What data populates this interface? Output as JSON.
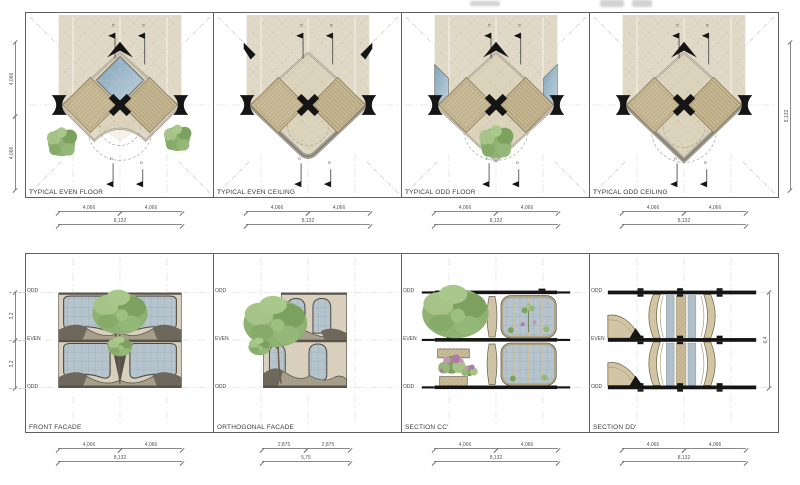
{
  "plans": [
    {
      "label": "TYPICAL EVEN FLOOR",
      "dim_a": "4,066",
      "dim_b": "4,066",
      "dim_total": "8,132"
    },
    {
      "label": "TYPICAL EVEN CEILING",
      "dim_a": "4,066",
      "dim_b": "4,066",
      "dim_total": "8,132"
    },
    {
      "label": "TYPICAL ODD FLOOR",
      "dim_a": "4,066",
      "dim_b": "4,066",
      "dim_total": "8,132"
    },
    {
      "label": "TYPICAL ODD CEILING",
      "dim_a": "4,066",
      "dim_b": "4,066",
      "dim_total": "8,132"
    }
  ],
  "elevations": [
    {
      "label": "FRONT FACADE",
      "dim_a": "4,066",
      "dim_b": "4,066",
      "dim_total": "8,132"
    },
    {
      "label": "ORTHOGONAL FACADE",
      "dim_a": "2,875",
      "dim_b": "2,875",
      "dim_total": "5,75"
    },
    {
      "label": "SECTION CC'",
      "dim_a": "4,066",
      "dim_b": "4,066",
      "dim_total": "8,132"
    },
    {
      "label": "SECTION DD'",
      "dim_a": "4,066",
      "dim_b": "4,066",
      "dim_total": "8,132"
    }
  ],
  "side_dims": {
    "plan_left_a": "4,066",
    "plan_left_b": "4,066",
    "plan_right_total": "8,132",
    "elev_left_a": "3,2",
    "elev_left_b": "3,2",
    "elev_right_total": "6,4"
  },
  "levels": [
    "ODD",
    "EVEN",
    "ODD"
  ],
  "markers": {
    "c_top": "C'",
    "d_top": "D'",
    "c_bot": "C",
    "d_bot": "D"
  },
  "colors": {
    "beige": "#e1d9c7",
    "deck_hatch": "#cbbd9b",
    "glass_blue": "#9fb8c8",
    "tree_green": "#8fb272",
    "slab_black": "#151515",
    "dim_line": "#8a8a8a"
  }
}
